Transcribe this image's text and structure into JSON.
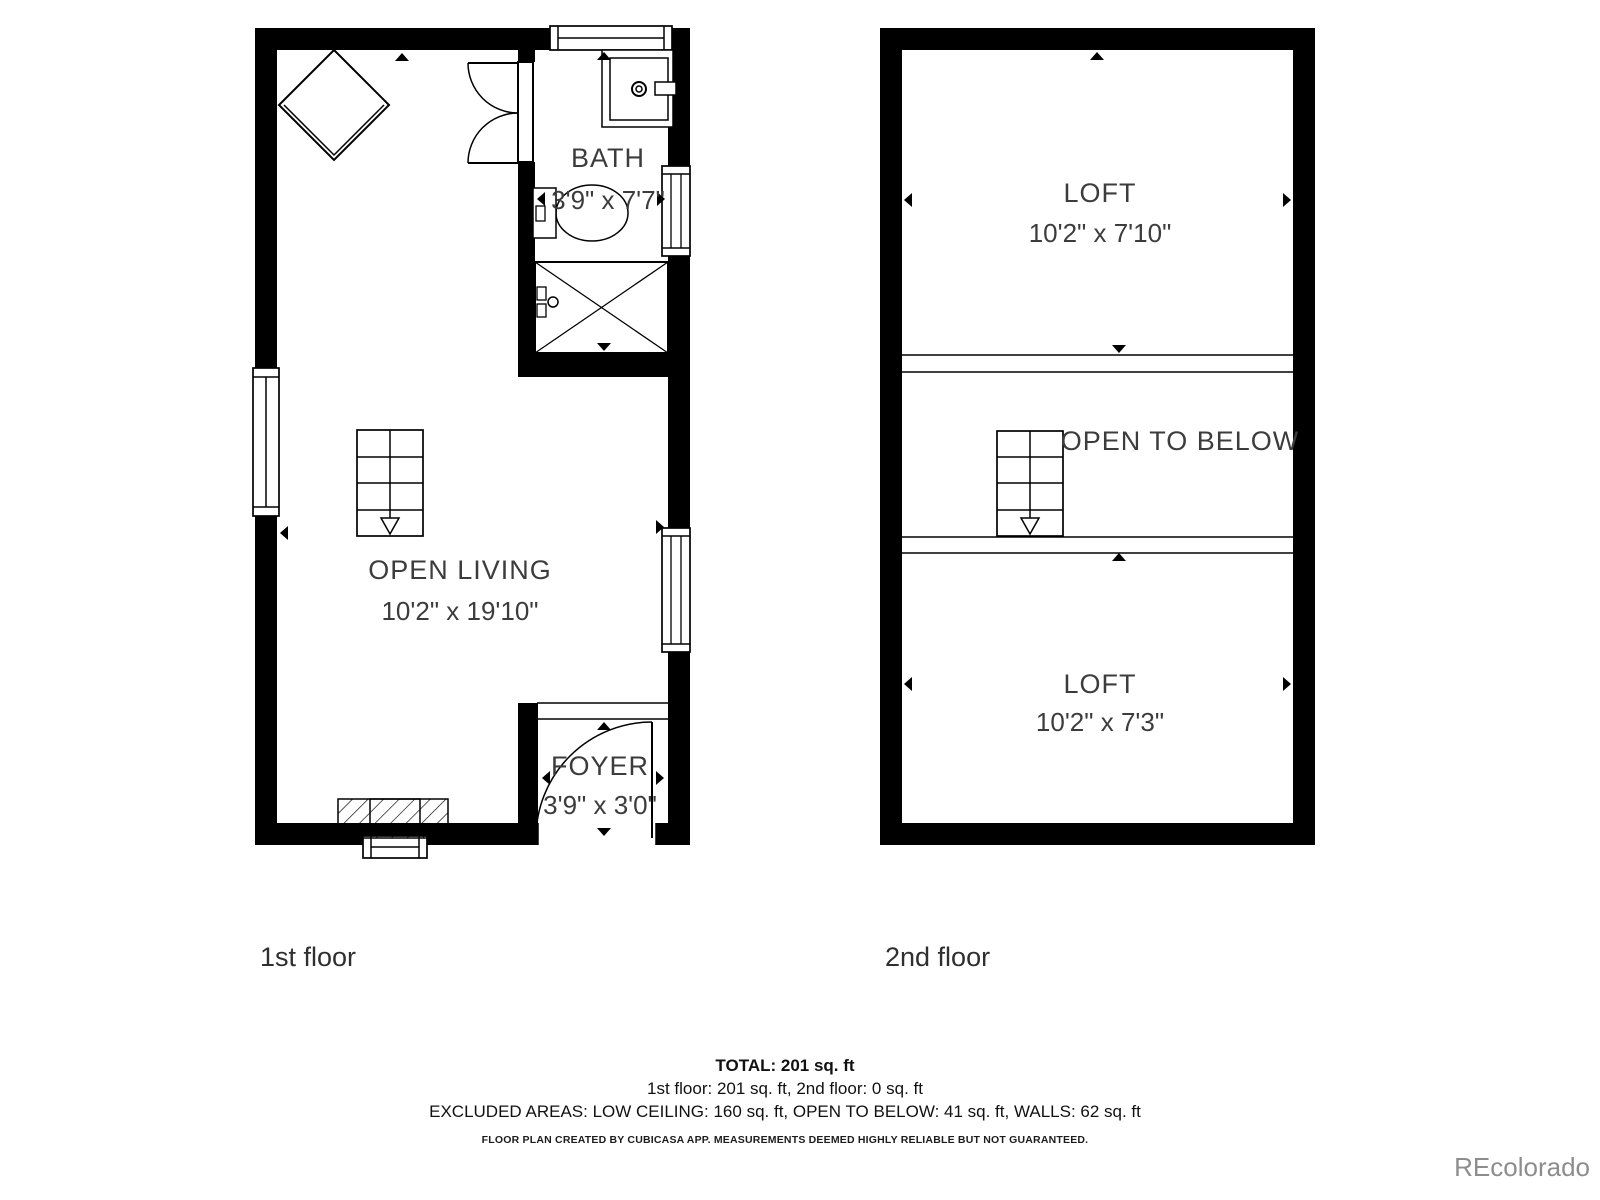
{
  "floors": {
    "first": {
      "label": "1st floor",
      "rooms": {
        "open_living": {
          "name": "OPEN LIVING",
          "dims": "10'2\" x 19'10\""
        },
        "bath": {
          "name": "BATH",
          "dims": "3'9\" x 7'7\""
        },
        "foyer": {
          "name": "FOYER",
          "dims": "3'9\" x 3'0\""
        }
      }
    },
    "second": {
      "label": "2nd floor",
      "rooms": {
        "loft_upper": {
          "name": "LOFT",
          "dims": "10'2\" x 7'10\""
        },
        "open_to_below": {
          "name": "OPEN TO BELOW"
        },
        "loft_lower": {
          "name": "LOFT",
          "dims": "10'2\" x 7'3\""
        }
      }
    }
  },
  "summary": {
    "total": "TOTAL: 201 sq. ft",
    "floor_breakdown": "1st floor: 201 sq. ft, 2nd floor: 0 sq. ft",
    "excluded": "EXCLUDED AREAS: LOW CEILING: 160 sq. ft, OPEN TO BELOW: 41 sq. ft, WALLS: 62 sq. ft",
    "disclaimer": "FLOOR PLAN CREATED BY CUBICASA APP. MEASUREMENTS DEEMED HIGHLY RELIABLE BUT NOT GUARANTEED."
  },
  "watermark": {
    "text": "REcolorado"
  },
  "colors": {
    "wall": "#000000",
    "room_text": "#3c3c3c",
    "footer_text": "#111111",
    "watermark": "#8d8d8d"
  }
}
